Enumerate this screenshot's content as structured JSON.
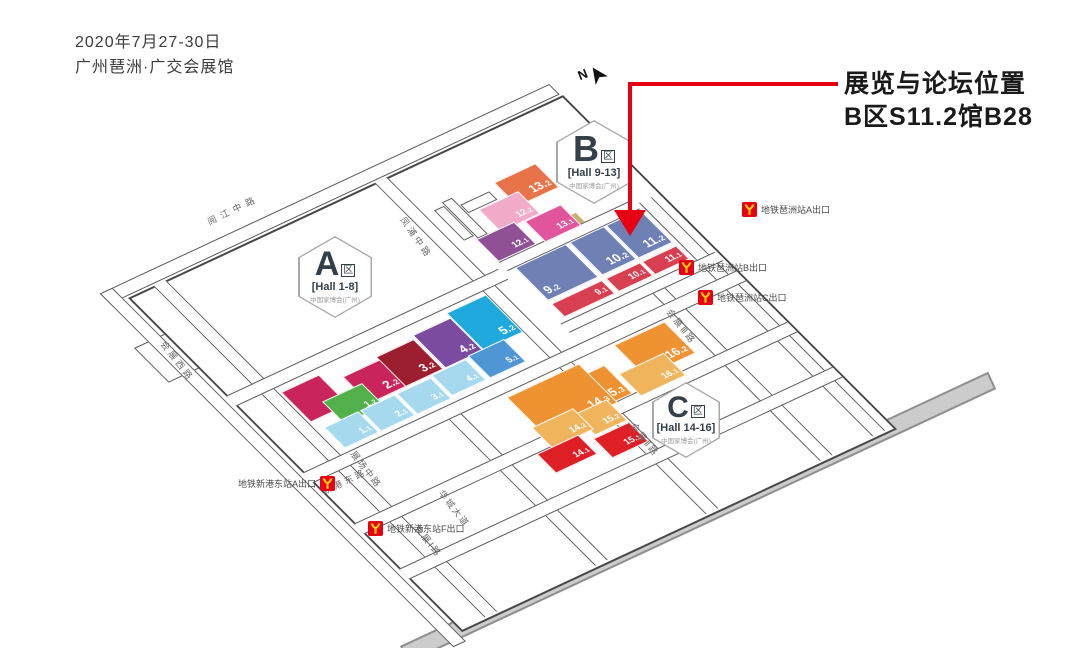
{
  "header": {
    "date_line": "2020年7月27-30日",
    "venue_line": "广州琶洲·广交会展馆"
  },
  "callout": {
    "title": "展览与论坛位置",
    "location": "B区S11.2馆B28"
  },
  "compass": {
    "label": "N"
  },
  "zones": [
    {
      "id": "A",
      "letter": "A",
      "area_suffix": "区",
      "hall_range": "[Hall 1-8]",
      "subtitle": "中国家博会(广州)"
    },
    {
      "id": "B",
      "letter": "B",
      "area_suffix": "区",
      "hall_range": "[Hall 9-13]",
      "subtitle": "中国家博会(广州)"
    },
    {
      "id": "C",
      "letter": "C",
      "area_suffix": "区",
      "hall_range": "[Hall 14-16]",
      "subtitle": "中国家博会(广州)"
    }
  ],
  "halls": [
    {
      "id": "annex",
      "label": "",
      "color": "#c9255c"
    },
    {
      "id": "2.2",
      "label": "2.2",
      "color": "#c9255c"
    },
    {
      "id": "3.2",
      "label": "3.2",
      "color": "#9c1f30"
    },
    {
      "id": "4.2",
      "label": "4.2",
      "color": "#7a4b9f"
    },
    {
      "id": "5.2",
      "label": "5.2",
      "color": "#1fa9dc"
    },
    {
      "id": "1.2",
      "label": "1.2",
      "color": "#52b14b"
    },
    {
      "id": "1.1",
      "label": "1.1",
      "color": "#a6d9ee"
    },
    {
      "id": "2.1",
      "label": "2.1",
      "color": "#a6d9ee"
    },
    {
      "id": "3.1",
      "label": "3.1",
      "color": "#a6d9ee"
    },
    {
      "id": "4.1",
      "label": "4.1",
      "color": "#a6d9ee"
    },
    {
      "id": "5.1",
      "label": "5.1",
      "color": "#4f97d4"
    },
    {
      "id": "9.2",
      "label": "9.2",
      "color": "#6e80b4"
    },
    {
      "id": "10.2",
      "label": "10.2",
      "color": "#6e80b4"
    },
    {
      "id": "11.2",
      "label": "11.2",
      "color": "#6e80b4"
    },
    {
      "id": "9.1",
      "label": "9.1",
      "color": "#d84052"
    },
    {
      "id": "10.1",
      "label": "10.1",
      "color": "#d84052"
    },
    {
      "id": "11.1",
      "label": "11.1",
      "color": "#d84052"
    },
    {
      "id": "13.2",
      "label": "13.2",
      "color": "#e87348"
    },
    {
      "id": "12.2",
      "label": "12.2",
      "color": "#f2abc9"
    },
    {
      "id": "13.1",
      "label": "13.1",
      "color": "#e0559b"
    },
    {
      "id": "12.1",
      "label": "12.1",
      "color": "#8f5096"
    },
    {
      "id": "16.2",
      "label": "16.2",
      "color": "#ef9231"
    },
    {
      "id": "15.3",
      "label": "15.3",
      "color": "#ef9231"
    },
    {
      "id": "14.3",
      "label": "14.3",
      "color": "#ef9231"
    },
    {
      "id": "16.1",
      "label": "16.1",
      "color": "#f0b55c"
    },
    {
      "id": "15.2",
      "label": "15.2",
      "color": "#f0b55c"
    },
    {
      "id": "14.2",
      "label": "14.2",
      "color": "#f0b55c"
    },
    {
      "id": "15.1",
      "label": "15.1",
      "color": "#de1f26"
    },
    {
      "id": "14.1",
      "label": "14.1",
      "color": "#de1f26"
    }
  ],
  "metro_exits": [
    {
      "id": "pazhou-a",
      "label": "地铁琶洲站A出口"
    },
    {
      "id": "pazhou-b",
      "label": "地铁琶洲站B出口"
    },
    {
      "id": "pazhou-c",
      "label": "地铁琶洲站C出口"
    },
    {
      "id": "xingangdong-a",
      "label": "地铁新港东站A出口"
    },
    {
      "id": "xingangdong-f",
      "label": "地铁新港东站F出口"
    }
  ],
  "roads": [
    {
      "id": "yuejiang",
      "name": "阅江中路"
    },
    {
      "id": "fengpu",
      "name": "凤浦中路"
    },
    {
      "id": "huizhan-xi",
      "name": "会展西路"
    },
    {
      "id": "huizhan-3",
      "name": "会展Ⅲ路"
    },
    {
      "id": "huizhan-2",
      "name": "会展Ⅱ路"
    },
    {
      "id": "huizhan-1",
      "name": "会展Ⅰ路"
    },
    {
      "id": "zhanchang",
      "name": "展场中路"
    },
    {
      "id": "xingang",
      "name": "新港东路"
    },
    {
      "id": "huacheng",
      "name": "华城大道"
    }
  ],
  "colors": {
    "arrow": "#e60012",
    "callout_text": "#1a1a1a",
    "metro_red": "#e60012",
    "metro_yellow": "#ffd400",
    "band_gray": "#cccccc",
    "zone_text": "#334049",
    "road_line": "#5a5a5a"
  }
}
